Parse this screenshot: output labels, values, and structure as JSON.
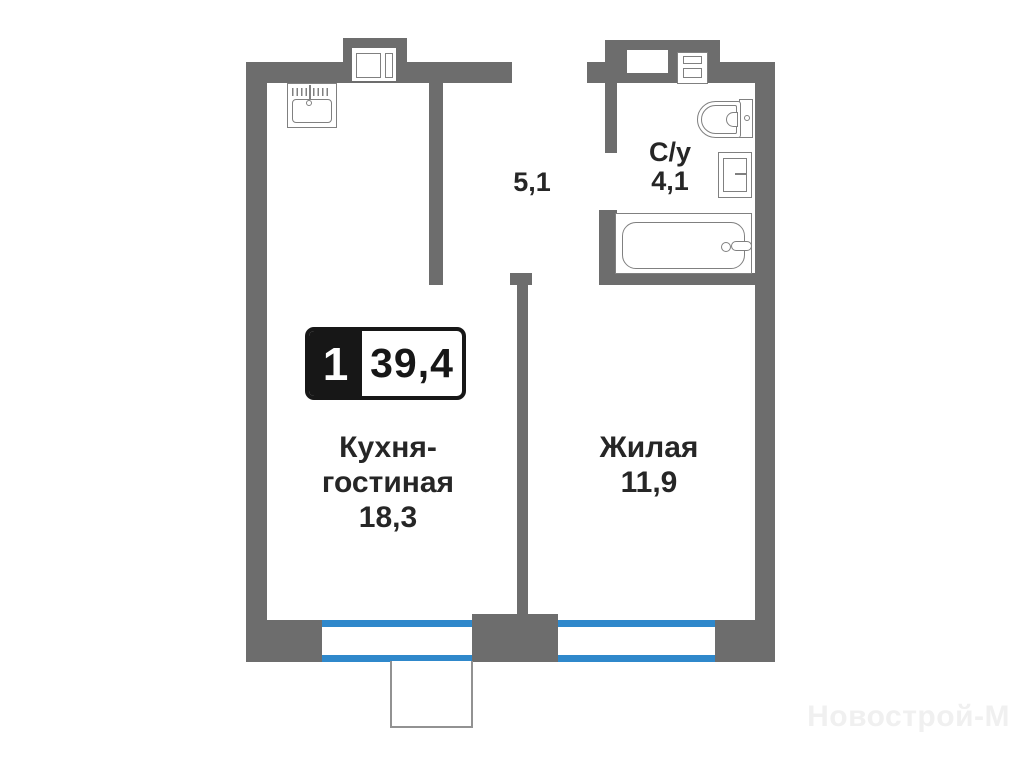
{
  "badge": {
    "rooms_count": "1",
    "total_area": "39,4"
  },
  "labels": {
    "hallway_area": "5,1",
    "bathroom_name": "С/у",
    "bathroom_area": "4,1",
    "kitchen_name": "Кухня-гостиная",
    "kitchen_area": "18,3",
    "living_name": "Жилая",
    "living_area": "11,9"
  },
  "watermark": "Новострой-М",
  "colors": {
    "wall": "#6d6d6d",
    "window_frame": "#2f88cb",
    "fixture_line": "#808080",
    "text": "#262626",
    "badge_black": "#171717",
    "watermark": "#f0f0f0"
  }
}
